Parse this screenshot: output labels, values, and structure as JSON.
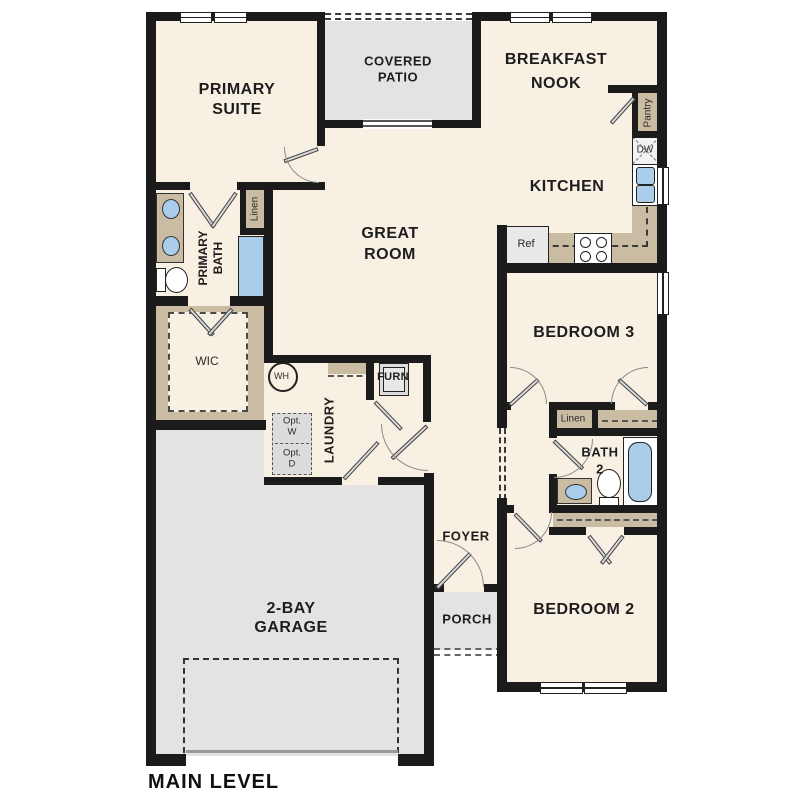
{
  "title": "MAIN LEVEL",
  "rooms": {
    "primary_suite": {
      "line1": "PRIMARY",
      "line2": "SUITE"
    },
    "covered_patio": {
      "line1": "COVERED",
      "line2": "PATIO"
    },
    "breakfast_nook": {
      "line1": "BREAKFAST",
      "line2": "NOOK"
    },
    "kitchen": {
      "label": "KITCHEN"
    },
    "great_room": {
      "line1": "GREAT",
      "line2": "ROOM"
    },
    "primary_bath": {
      "line1": "PRIMARY",
      "line2": "BATH"
    },
    "wic": {
      "label": "WIC"
    },
    "laundry": {
      "label": "LAUNDRY"
    },
    "bedroom3": {
      "label": "BEDROOM 3"
    },
    "bath2": {
      "line1": "BATH",
      "line2": "2"
    },
    "bedroom2": {
      "label": "BEDROOM 2"
    },
    "foyer": {
      "label": "FOYER"
    },
    "porch": {
      "label": "PORCH"
    },
    "garage": {
      "line1": "2-BAY",
      "line2": "GARAGE"
    }
  },
  "fixtures": {
    "pantry": "Pantry",
    "dishwasher": "DW",
    "refrigerator": "Ref",
    "water_heater": "WH",
    "furnace": "FURN",
    "linen_bath": "Linen",
    "linen_hall": "Linen",
    "opt_washer_line1": "Opt.",
    "opt_washer_line2": "W",
    "opt_dryer_line1": "Opt.",
    "opt_dryer_line2": "D"
  },
  "colors": {
    "wall": "#1b1b1b",
    "floor_cream": "#f8f0e2",
    "area_gray": "#e4e3e1",
    "cabinet_tan": "#cabba3",
    "fixture_blue": "#a9cdea",
    "optional_gray": "#dcdcdc"
  }
}
